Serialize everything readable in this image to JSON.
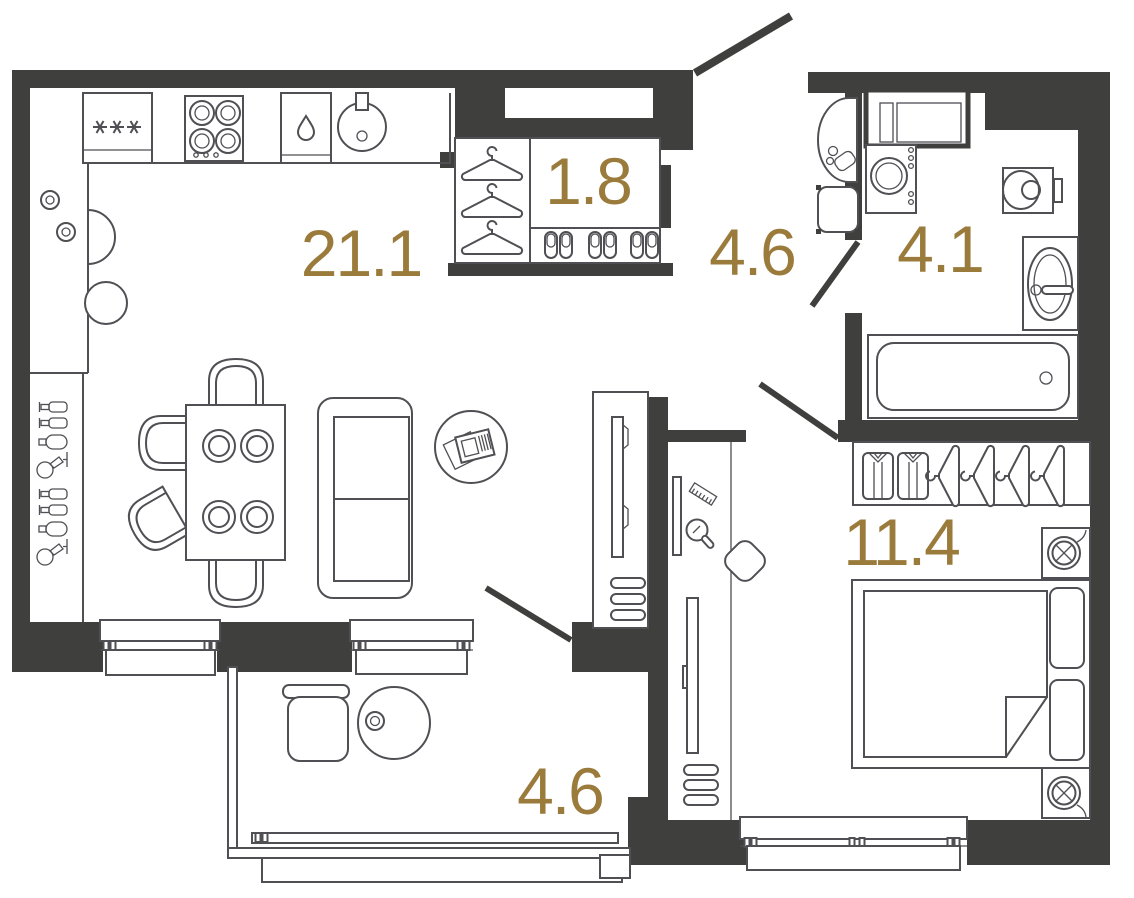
{
  "plan": {
    "type": "apartment-floor-plan",
    "colors": {
      "wall": "#3f3f3d",
      "line": "#4f4f54",
      "label": "#9a7b3c",
      "bg": "#ffffff"
    },
    "rooms": [
      {
        "id": "living-kitchen",
        "label": "21.1"
      },
      {
        "id": "entry-closet",
        "label": "1.8"
      },
      {
        "id": "hallway",
        "label": "4.6"
      },
      {
        "id": "bathroom",
        "label": "4.1"
      },
      {
        "id": "bedroom",
        "label": "11.4"
      },
      {
        "id": "loggia",
        "label": "4.6"
      }
    ],
    "icons": [
      "fridge-icon",
      "stove-icon",
      "dishwasher-drop-icon",
      "kitchen-sink-icon",
      "plates-icon",
      "bar-bottles-icon",
      "wine-glass-icon",
      "dining-table-icon",
      "chair-icon",
      "sofa-icon",
      "rug-newspaper-icon",
      "tv-icon",
      "vent-grille-icon",
      "hanger-icon",
      "slippers-icon",
      "entry-door-icon",
      "wall-sink-icon",
      "laundry-basket-icon",
      "duct-shaft-icon",
      "washing-machine-icon",
      "toilet-icon",
      "vanity-sink-icon",
      "bathtub-icon",
      "dressing-shelf-icon",
      "comb-icon",
      "hand-mirror-icon",
      "stool-icon",
      "floor-mirror-icon",
      "radiator-icon",
      "shirt-icon",
      "bed-icon",
      "pillow-icon",
      "nightstand-lamp-icon",
      "window-icon",
      "armchair-icon",
      "coffee-table-icon",
      "cup-icon"
    ]
  }
}
